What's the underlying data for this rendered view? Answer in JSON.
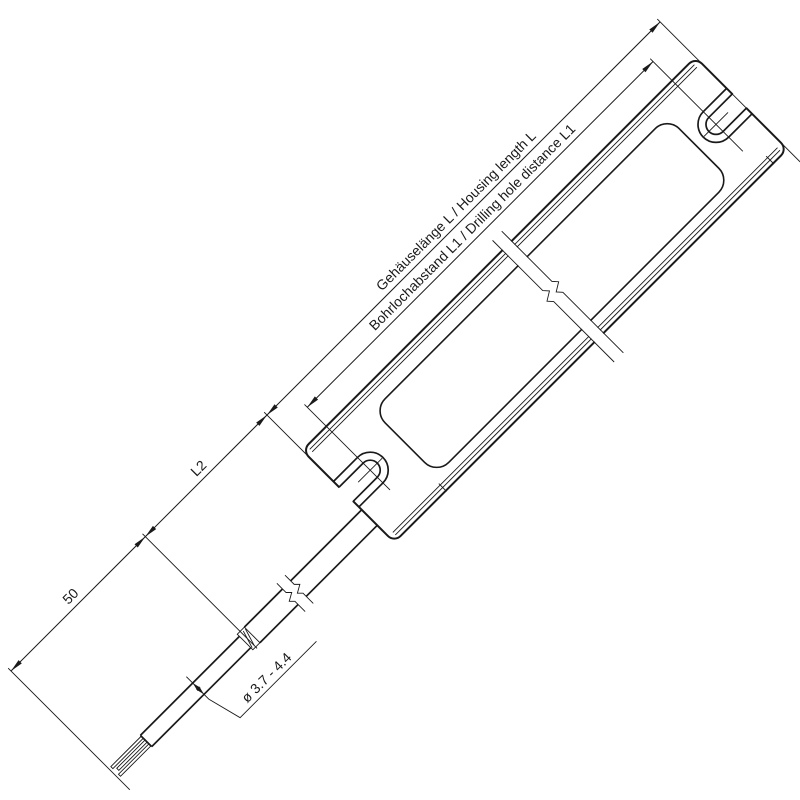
{
  "dims": {
    "housing_length": "Gehäuselänge L / Housing length L",
    "hole_distance": "Bohrlochabstand L1 / Drilling hole distance L1",
    "cable_length": "L2",
    "strip_length": "50",
    "cable_diameter": "ø 3.7 - 4.4"
  },
  "colors": {
    "line": "#1a1a1a",
    "background": "#ffffff"
  }
}
